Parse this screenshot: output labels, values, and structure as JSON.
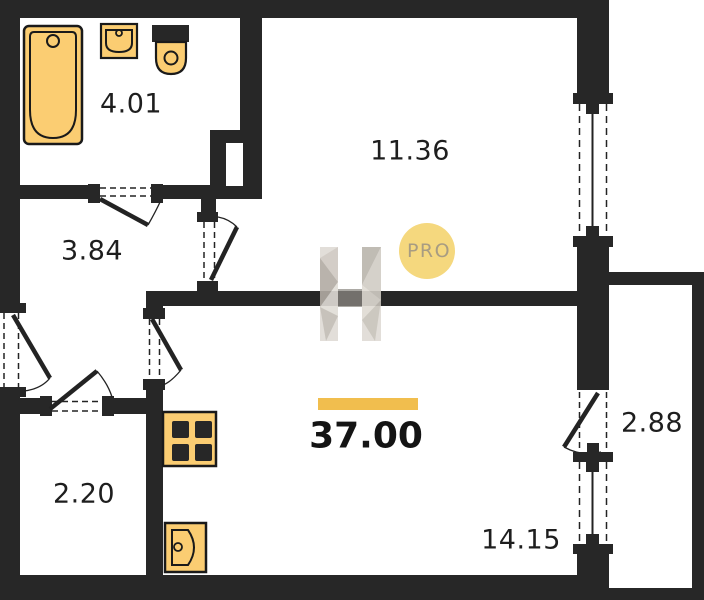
{
  "plan": {
    "rooms": {
      "bathroom": "4.01",
      "hallway": "3.84",
      "top_room": "11.36",
      "closet": "2.20",
      "bottom_room": "14.15",
      "balcony": "2.88"
    },
    "total_area": "37.00",
    "watermark": {
      "logo_letter": "H",
      "badge": "PRO"
    },
    "colors": {
      "wall": "#272727",
      "fixture_fill": "#FBCD72",
      "fixture_stroke": "#1a1a1a",
      "accent_bar": "#F1BE4E",
      "badge_fill": "#F5D87E",
      "badge_text": "#A89C82",
      "label_text": "#1e1e1e"
    }
  }
}
